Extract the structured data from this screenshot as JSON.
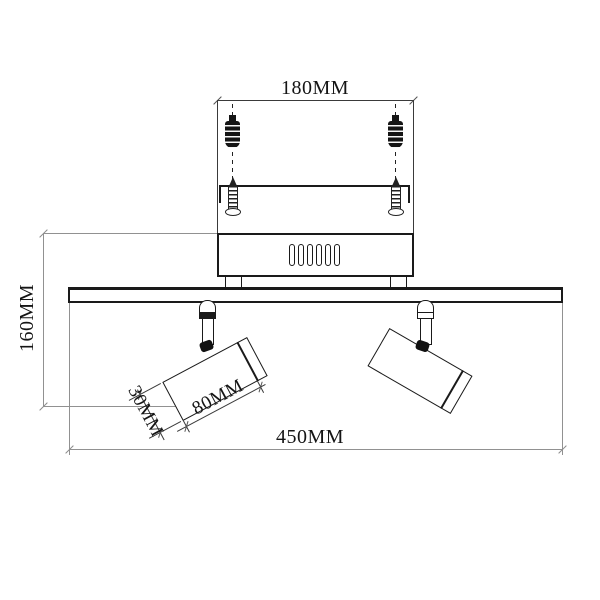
{
  "drawing": {
    "type": "technical dimension drawing",
    "subject": "two-head ceiling spotlight fixture with mounting hardware",
    "dimensions": {
      "mount_plate_width": "180MM",
      "fixture_height": "160MM",
      "head_diameter": "30MM",
      "head_length": "80MM",
      "bar_width": "450MM"
    },
    "colors": {
      "outline": "#1a1a1a",
      "dimension_line_gray": "#919191",
      "dimension_line_dark": "#3a3a3a",
      "background": "#ffffff"
    }
  }
}
